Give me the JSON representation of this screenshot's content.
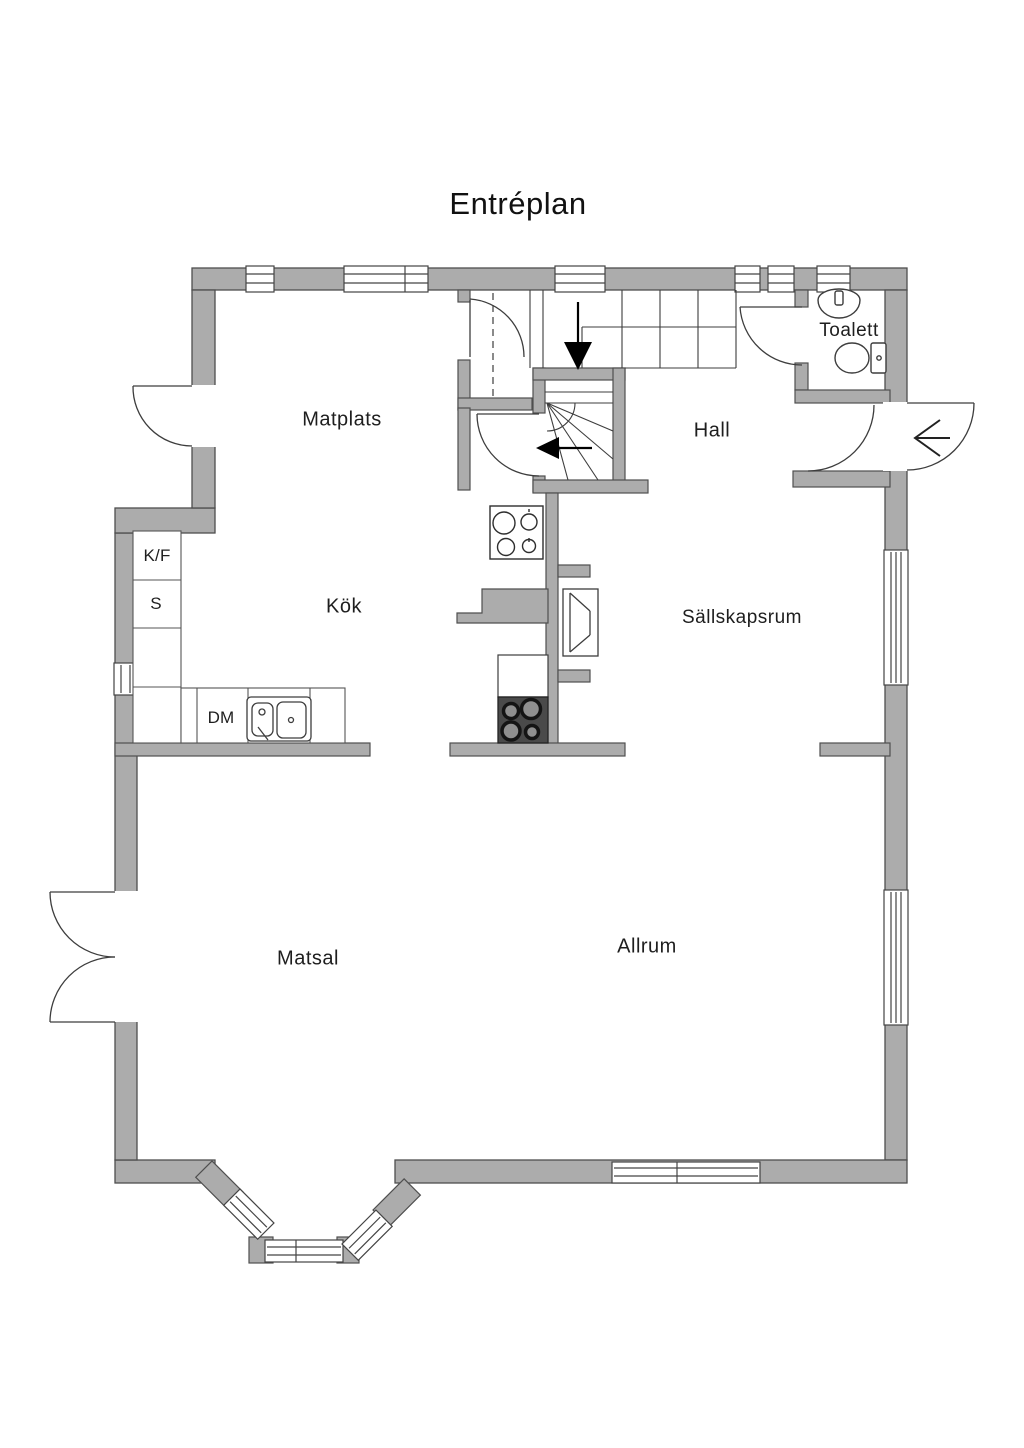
{
  "title": "Entréplan",
  "rooms": [
    {
      "name": "Matplats"
    },
    {
      "name": "Hall"
    },
    {
      "name": "Toalett"
    },
    {
      "name": "Kök"
    },
    {
      "name": "Sällskapsrum"
    },
    {
      "name": "Matsal"
    },
    {
      "name": "Allrum"
    }
  ],
  "kitchen": {
    "fridge_freezer": "K/F",
    "pantry": "S",
    "dishwasher": "DM"
  },
  "colors": {
    "background": "#FFFFFF",
    "wall_fill": "#ACACAC",
    "wall_outline": "#4F4F4F",
    "symbol_line": "#3D3D3D",
    "stove_dark": "#4A4A4A"
  },
  "fixtures": [
    "staircase-up",
    "winder-stairs",
    "fireplace",
    "cooktop",
    "stove",
    "kitchen-sink",
    "toilet",
    "washbasin",
    "clothes-rail",
    "bay-window"
  ],
  "arrows": {
    "entry_direction": "left",
    "stair_top_direction": "down",
    "stair_bottom_direction": "left"
  }
}
